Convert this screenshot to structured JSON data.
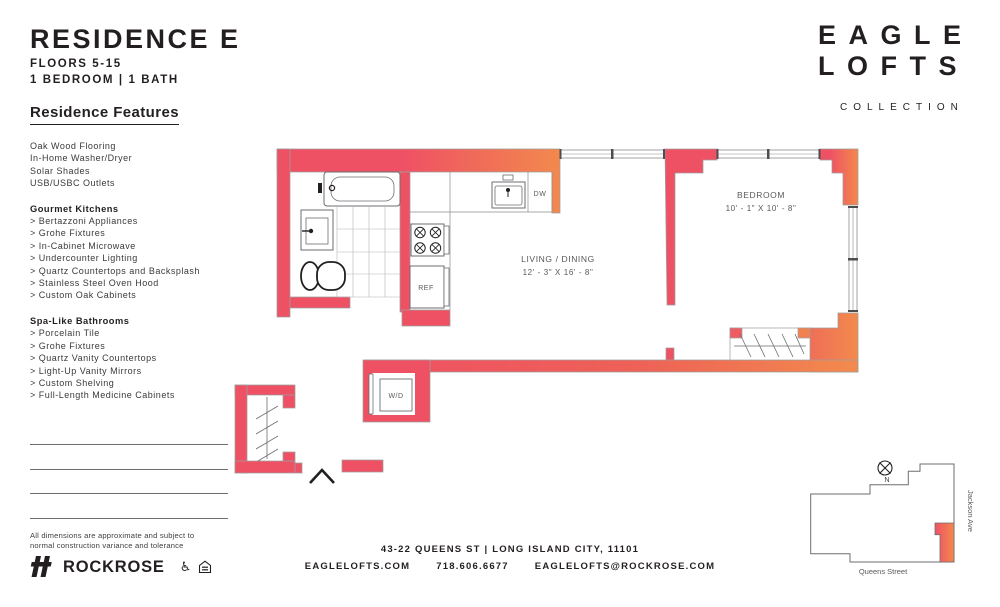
{
  "header": {
    "title": "RESIDENCE E",
    "floors": "FLOORS 5-15",
    "config": "1 BEDROOM  |  1 BATH"
  },
  "brand": {
    "line1": "EAGLE",
    "line2": "LOFTS",
    "tagline": "COLLECTION"
  },
  "features": {
    "heading": "Residence Features",
    "general": [
      "Oak Wood Flooring",
      "In-Home Washer/Dryer",
      "Solar Shades",
      "USB/USBC Outlets"
    ],
    "kitchen_heading": "Gourmet Kitchens",
    "kitchen": [
      "> Bertazzoni Appliances",
      "> Grohe Fixtures",
      "> In-Cabinet Microwave",
      "> Undercounter Lighting",
      "> Quartz Countertops and Backsplash",
      "> Stainless Steel Oven Hood",
      "> Custom Oak Cabinets"
    ],
    "bath_heading": "Spa-Like Bathrooms",
    "bath": [
      "> Porcelain Tile",
      "> Grohe Fixtures",
      "> Quartz Vanity Countertops",
      "> Light-Up Vanity Mirrors",
      "> Custom Shelving",
      "> Full-Length Medicine Cabinets"
    ]
  },
  "plan": {
    "living": {
      "name": "LIVING / DINING",
      "dims": "12' - 3\" X 16' - 8\""
    },
    "bedroom": {
      "name": "BEDROOM",
      "dims": "10' - 1\" X 10' - 8\""
    },
    "appliances": {
      "ref": "REF",
      "dw": "DW",
      "wd": "W/D"
    }
  },
  "map": {
    "street_right": "Jackson Ave",
    "street_bottom": "Queens Street",
    "compass": "N"
  },
  "disclaimer": {
    "line1": "All dimensions are approximate and subject to",
    "line2": "normal construction variance and tolerance"
  },
  "footer": {
    "address": "43-22 QUEENS ST  |  LONG ISLAND CITY, 11101",
    "website": "EAGLELOFTS.COM",
    "phone": "718.606.6677",
    "email": "EAGLELOFTS@ROCKROSE.COM",
    "developer": "ROCKROSE"
  },
  "colors": {
    "wall_red": "#EF5164",
    "wall_orange": "#F28B4D",
    "line_gray": "#6D6E71",
    "text_dark": "#231F20"
  }
}
